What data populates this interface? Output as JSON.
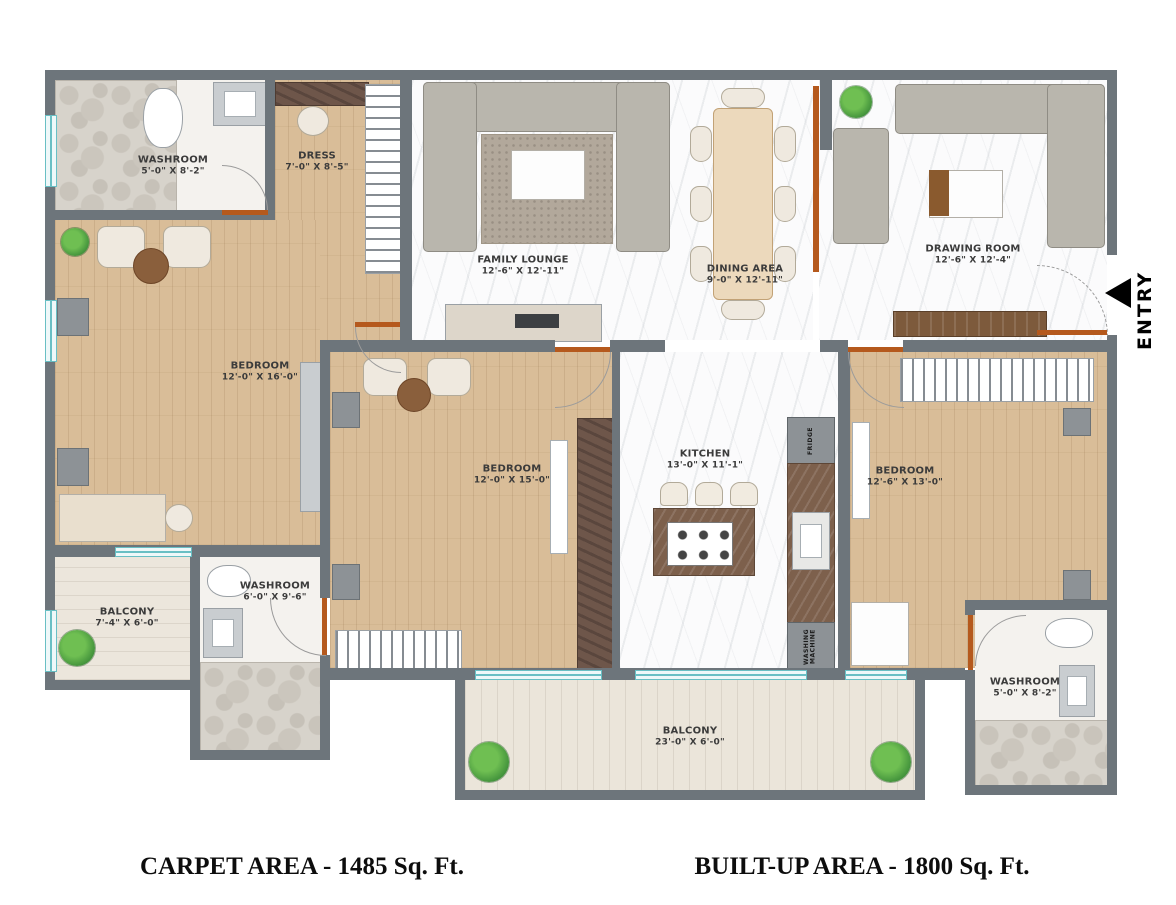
{
  "plan": {
    "rooms": [
      {
        "name": "WASHROOM",
        "dims": "5'-0\" X 8'-2\""
      },
      {
        "name": "DRESS",
        "dims": "7'-0\" X 8'-5\""
      },
      {
        "name": "FAMILY LOUNGE",
        "dims": "12'-6\" X 12'-11\""
      },
      {
        "name": "DINING AREA",
        "dims": "9'-0\" X 12'-11\""
      },
      {
        "name": "DRAWING ROOM",
        "dims": "12'-6\" X 12'-4\""
      },
      {
        "name": "BEDROOM",
        "dims": "12'-0\" X 16'-0\""
      },
      {
        "name": "BEDROOM",
        "dims": "12'-0\" X 15'-0\""
      },
      {
        "name": "KITCHEN",
        "dims": "13'-0\" X 11'-1\""
      },
      {
        "name": "BEDROOM",
        "dims": "12'-6\" X 13'-0\""
      },
      {
        "name": "BALCONY",
        "dims": "7'-4\" X 6'-0\""
      },
      {
        "name": "WASHROOM",
        "dims": "6'-0\" X 9'-6\""
      },
      {
        "name": "BALCONY",
        "dims": "23'-0\" X 6'-0\""
      },
      {
        "name": "WASHROOM",
        "dims": "5'-0\" X 8'-2\""
      }
    ],
    "appliances": {
      "fridge": "FRIDGE",
      "washing_machine": "WASHING\nMACHINE"
    },
    "entry": {
      "label": "ENTRY"
    }
  },
  "footer": {
    "carpet_area": "CARPET AREA - 1485 Sq. Ft.",
    "builtup_area": "BUILT-UP AREA - 1800 Sq. Ft."
  },
  "colors": {
    "wall": "#6d757b",
    "door": "#b5591d",
    "window": "#69bfc4",
    "wood_floor": "#d9bd98",
    "balcony_floor": "#ebe5da",
    "marble_floor": "#fbfbfc",
    "sofa": "#b9b6ad"
  }
}
